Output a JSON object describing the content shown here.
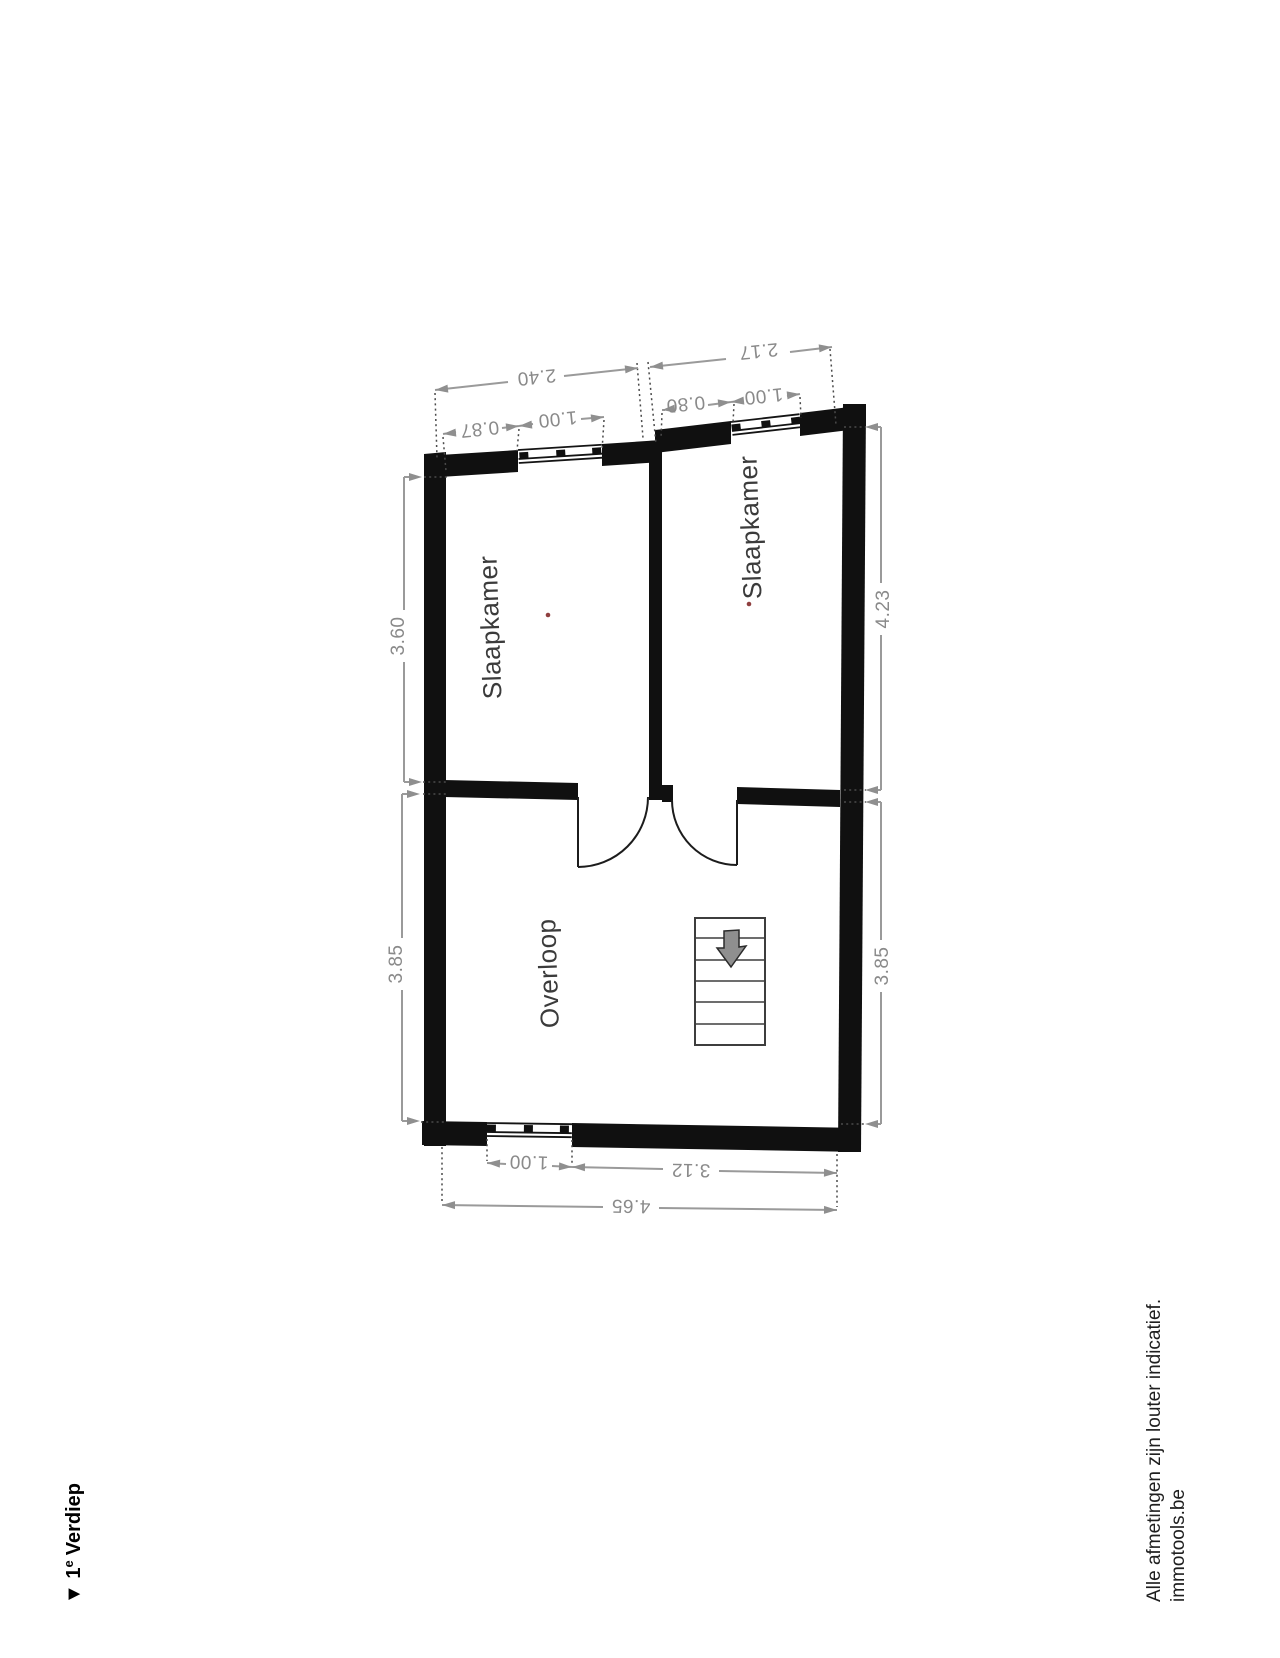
{
  "floor_plan": {
    "title": {
      "marker_num": "▼ 1",
      "superscript": "e",
      "name": "Verdiep"
    },
    "rooms": {
      "bedroom_left": "Slaapkamer",
      "bedroom_right": "Slaapkamer",
      "landing": "Overloop"
    },
    "dimensions": {
      "top_left_total": "2.40",
      "top_right_total": "2.17",
      "top_left_offset": "0.87",
      "top_left_window": "1.00",
      "top_right_offset": "0.80",
      "top_right_window": "1.00",
      "left_upper": "3.60",
      "left_lower": "3.85",
      "right_upper": "4.23",
      "right_lower": "3.85",
      "bottom_window": "1.00",
      "bottom_right": "3.12",
      "bottom_total": "4.65"
    },
    "footer": {
      "disclaimer": "Alle afmetingen zijn louter indicatief.",
      "brand": "immotools.be"
    },
    "colors": {
      "wall": "#101010",
      "dim_line": "#9a9a9a",
      "dim_text": "#8a8a8a",
      "room_text": "#3b3b3b",
      "stairs_arrow_fill": "#8f8f8f",
      "marker_dot": "#8f3f3f"
    }
  }
}
